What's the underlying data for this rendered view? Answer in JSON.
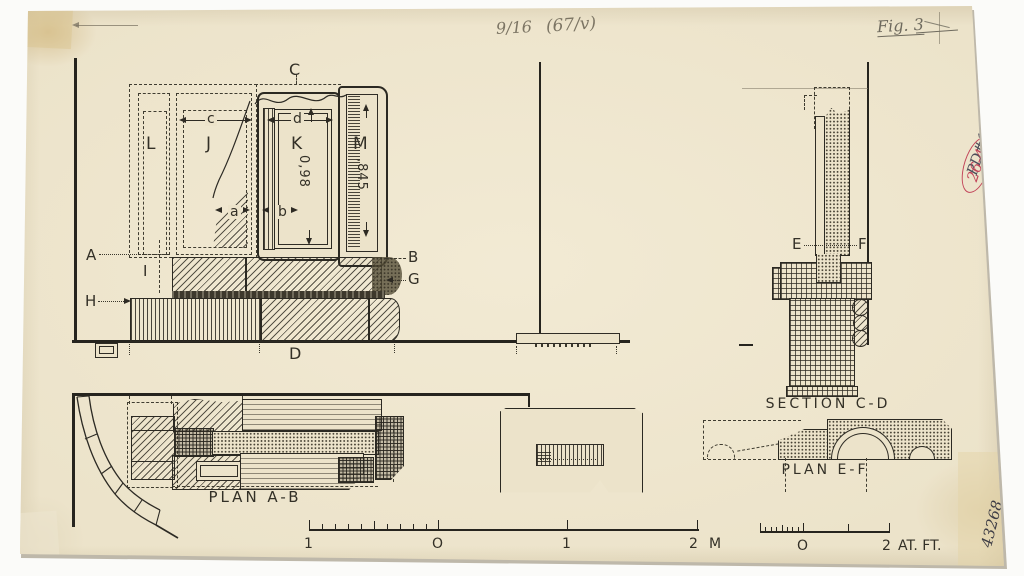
{
  "notes": {
    "fraction": "9/16",
    "paren": "(67/v)",
    "fig": "Fig. 3",
    "pd": "PD#1747",
    "red": "26-4",
    "accession": "43268"
  },
  "elevation": {
    "c": "C",
    "l": "L",
    "j": "J",
    "k": "K",
    "m": "M",
    "dim_c": "c",
    "dim_d": "d",
    "dim_a": "a",
    "dim_b": "b",
    "k_h": "0,98",
    "m_h": ",845",
    "a": "A",
    "b": "B",
    "g": "G",
    "h": "H",
    "i": "I",
    "d": "D"
  },
  "section": {
    "title": "SECTION C-D",
    "e": "E",
    "f": "F"
  },
  "plan_ab": {
    "title": "PLAN A-B"
  },
  "plan_ef": {
    "title": "PLAN E-F"
  },
  "scale_m": {
    "l1": "1",
    "l2": "O",
    "l3": "1",
    "l4": "2",
    "unit": "M"
  },
  "scale_ft": {
    "l1": "O",
    "l2": "2",
    "unit": "AT. FT."
  },
  "colors": {
    "paper": "#ece3ca",
    "ink": "#26241e",
    "pencil": "#7c7564",
    "red": "#c2455a"
  }
}
